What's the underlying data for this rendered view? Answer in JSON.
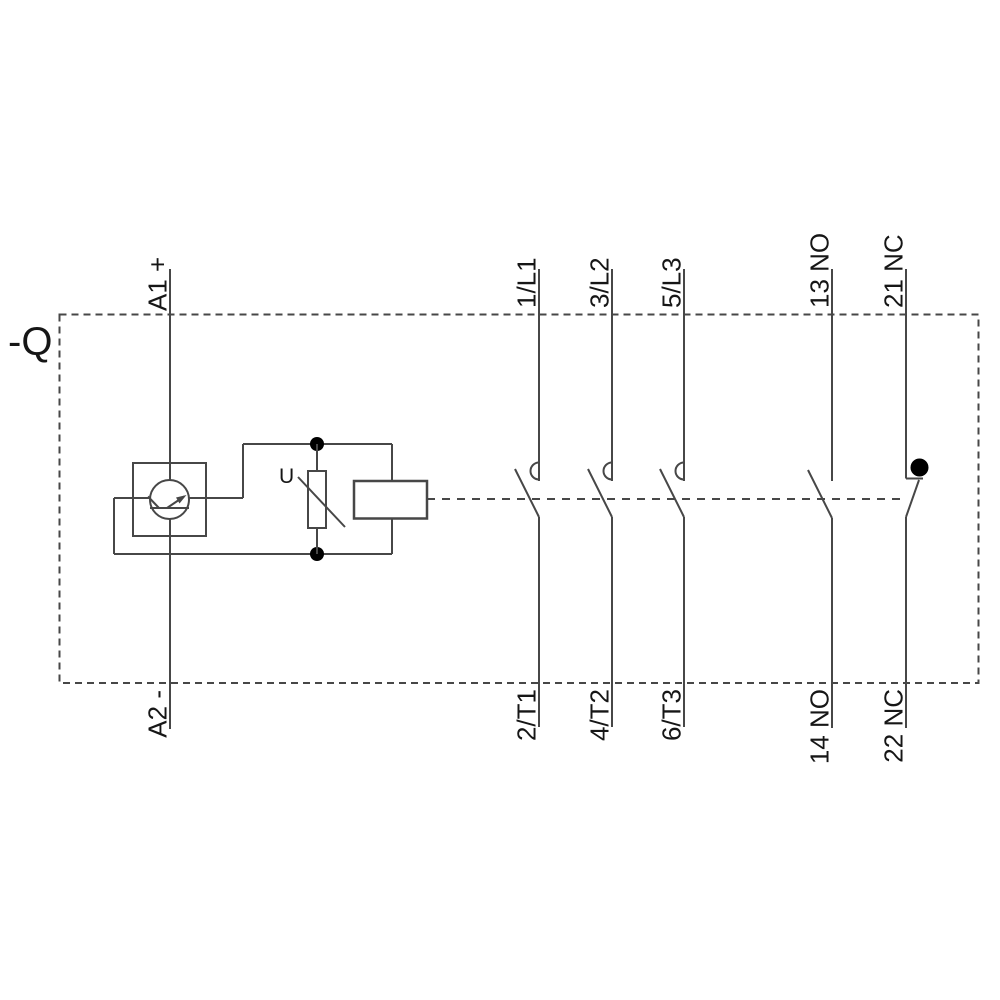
{
  "diagram": {
    "device_label": "-Q",
    "varistor_label": "U",
    "terminals": {
      "a1": "A1 +",
      "a2": "A2 -",
      "poles_top": [
        "1/L1",
        "3/L2",
        "5/L3"
      ],
      "poles_bottom": [
        "2/T1",
        "4/T2",
        "6/T3"
      ],
      "aux_top": [
        "13 NO",
        "21 NC"
      ],
      "aux_bottom": [
        "14 NO",
        "22 NC"
      ]
    },
    "colors": {
      "background": "#ffffff",
      "line": "#474747",
      "text": "#161616",
      "dot": "#000000"
    }
  }
}
